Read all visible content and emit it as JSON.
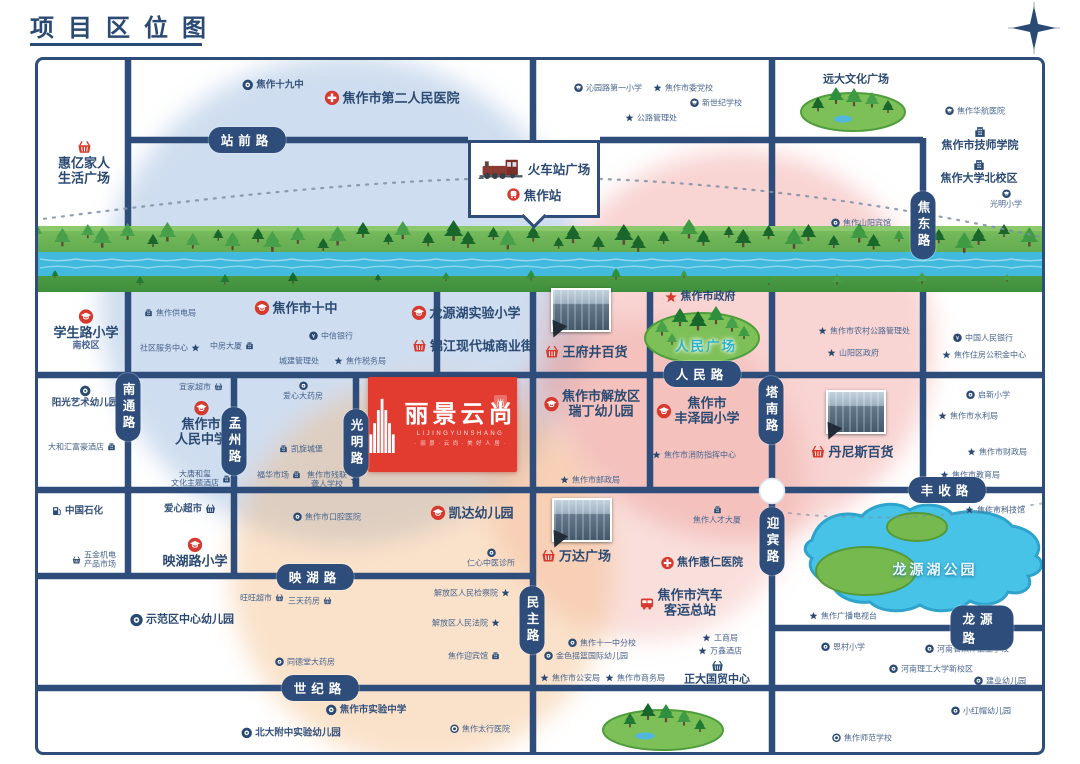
{
  "title": "项目区位图",
  "colors": {
    "navy": "#2b4a73",
    "road": "#2e4d7b",
    "red": "#d6392e",
    "river": "#41bade",
    "lake": "#47c3e8",
    "green": "#58a84e",
    "zone_blue": "rgba(132,170,214,0.40)",
    "zone_pink": "rgba(236,142,138,0.38)",
    "zone_pink2": "rgba(236,150,140,0.30)",
    "zone_orange": "rgba(244,186,128,0.42)"
  },
  "station": {
    "plaza_label": "火车站广场",
    "station_label": "焦作站"
  },
  "project": {
    "name": "丽景云尚",
    "pinyin": "LIJINGYUNSHANG",
    "tagline": "· 丽 景 · 云 尚 · 美 好 人 居 ·",
    "seal_text": "尚"
  },
  "lake_label": "龙源湖公园",
  "roads": [
    {
      "name": "站前路",
      "o": "h",
      "x": 247,
      "y": 140
    },
    {
      "name": "人民路",
      "o": "h",
      "x": 702,
      "y": 374
    },
    {
      "name": "丰收路",
      "o": "h",
      "x": 947,
      "y": 490
    },
    {
      "name": "映湖路",
      "o": "h",
      "x": 315,
      "y": 577
    },
    {
      "name": "龙源路",
      "o": "h",
      "x": 982,
      "y": 628
    },
    {
      "name": "世纪路",
      "o": "h",
      "x": 320,
      "y": 688
    },
    {
      "name": "南通路",
      "o": "v",
      "x": 128,
      "y": 407
    },
    {
      "name": "孟州路",
      "o": "v",
      "x": 234,
      "y": 441
    },
    {
      "name": "光明路",
      "o": "v",
      "x": 356,
      "y": 443
    },
    {
      "name": "民主路",
      "o": "v",
      "x": 532,
      "y": 620
    },
    {
      "name": "塔南路",
      "o": "v",
      "x": 771,
      "y": 410
    },
    {
      "name": "迎宾路",
      "o": "v",
      "x": 772,
      "y": 541
    },
    {
      "name": "焦东路",
      "o": "v",
      "x": 923,
      "y": 225
    }
  ],
  "photos": [
    {
      "name": "wangfujing-photo",
      "x": 581,
      "y": 310
    },
    {
      "name": "dennis-photo",
      "x": 856,
      "y": 412
    },
    {
      "name": "wanda-photo",
      "x": 582,
      "y": 520
    }
  ],
  "pois": [
    {
      "lines": [
        "惠亿家人",
        "生活广场"
      ],
      "icon": "basket",
      "color": "red",
      "size": "lg",
      "col": true,
      "x": 84,
      "y": 163
    },
    {
      "label": "焦作十九中",
      "icon": "circle",
      "color": "navy",
      "size": "sm",
      "x": 273,
      "y": 85
    },
    {
      "label": "焦作市第二人民医院",
      "icon": "hospital",
      "color": "red",
      "size": "lg",
      "x": 392,
      "y": 98
    },
    {
      "label": "沁园路第一小学",
      "icon": "school",
      "color": "navy",
      "size": "xs",
      "x": 608,
      "y": 88
    },
    {
      "label": "焦作市委党校",
      "icon": "star",
      "color": "navy",
      "size": "xs",
      "x": 683,
      "y": 88
    },
    {
      "label": "新世纪学校",
      "icon": "school",
      "color": "navy",
      "size": "xs",
      "x": 716,
      "y": 103
    },
    {
      "label": "公路管理处",
      "icon": "star",
      "color": "navy",
      "size": "xs",
      "x": 651,
      "y": 118
    },
    {
      "label": "远大文化广场",
      "size": "md",
      "x": 856,
      "y": 80
    },
    {
      "label": "焦作华航医院",
      "icon": "school",
      "color": "navy",
      "size": "xs",
      "x": 975,
      "y": 111
    },
    {
      "label": "焦作市技师学院",
      "icon": "building",
      "color": "navy",
      "size": "md",
      "col": true,
      "x": 980,
      "y": 139
    },
    {
      "label": "焦作大学北校区",
      "icon": "building",
      "color": "navy",
      "size": "md",
      "col": true,
      "x": 979,
      "y": 172
    },
    {
      "label": "光明小学",
      "icon": "school",
      "color": "navy",
      "size": "xs",
      "col": true,
      "x": 1006,
      "y": 199
    },
    {
      "label": "焦作山阳宾馆",
      "icon": "circle",
      "color": "navy",
      "size": "xs",
      "x": 861,
      "y": 223
    },
    {
      "lines": [
        "学生路小学"
      ],
      "sub": "南校区",
      "icon": "school",
      "color": "red",
      "size": "lg",
      "col": true,
      "x": 86,
      "y": 330
    },
    {
      "label": "焦作供电局",
      "icon": "building",
      "color": "navy",
      "size": "xs",
      "x": 170,
      "y": 313
    },
    {
      "label": "焦作市十中",
      "icon": "school",
      "color": "red",
      "size": "lg",
      "x": 296,
      "y": 308
    },
    {
      "label": "社区服务中心",
      "icon": "star",
      "color": "navy",
      "size": "xs",
      "iconRight": true,
      "x": 170,
      "y": 348
    },
    {
      "label": "中房大厦",
      "icon": "building",
      "color": "navy",
      "size": "xs",
      "iconRight": true,
      "x": 232,
      "y": 346
    },
    {
      "label": "中信银行",
      "icon": "bank",
      "color": "navy",
      "size": "xs",
      "x": 331,
      "y": 336
    },
    {
      "label": "城建管理处",
      "size": "xs",
      "x": 299,
      "y": 361
    },
    {
      "label": "焦作税务局",
      "icon": "star",
      "color": "navy",
      "size": "xs",
      "x": 360,
      "y": 361
    },
    {
      "label": "龙源湖实验小学",
      "icon": "school",
      "color": "red",
      "size": "lg",
      "x": 466,
      "y": 313
    },
    {
      "label": "锦江现代城商业街",
      "icon": "basket",
      "color": "red",
      "size": "lg",
      "x": 473,
      "y": 346
    },
    {
      "label": "王府井百货",
      "icon": "basket",
      "color": "red",
      "size": "lg",
      "x": 586,
      "y": 352
    },
    {
      "label": "焦作市政府",
      "icon": "star",
      "color": "red",
      "size": "md",
      "x": 700,
      "y": 297
    },
    {
      "label": "人民广场",
      "cls": "park-label",
      "x": 706,
      "y": 347
    },
    {
      "label": "焦作市农村公路管理处",
      "icon": "star",
      "color": "navy",
      "size": "xs",
      "x": 864,
      "y": 331
    },
    {
      "label": "山阳区政府",
      "icon": "star",
      "color": "navy",
      "size": "xs",
      "x": 853,
      "y": 353
    },
    {
      "label": "中国人民银行",
      "icon": "bank",
      "color": "navy",
      "size": "xs",
      "x": 983,
      "y": 338
    },
    {
      "label": "焦作住房公积金中心",
      "icon": "star",
      "color": "navy",
      "size": "xs",
      "x": 984,
      "y": 355
    },
    {
      "label": "阳光艺术幼儿园",
      "icon": "circle",
      "color": "navy",
      "size": "sm",
      "col": true,
      "x": 85,
      "y": 397
    },
    {
      "label": "大和汇富豪酒店",
      "icon": "building",
      "color": "navy",
      "size": "xs",
      "iconRight": true,
      "x": 82,
      "y": 447
    },
    {
      "label": "宜家超市",
      "icon": "basket",
      "color": "navy",
      "size": "xs",
      "iconRight": true,
      "x": 201,
      "y": 387
    },
    {
      "lines": [
        "焦作市",
        "人民中学"
      ],
      "icon": "school",
      "color": "red",
      "size": "lg",
      "col": true,
      "x": 201,
      "y": 424
    },
    {
      "lines": [
        "大唐和玺",
        "文化主题酒店"
      ],
      "icon": "building",
      "color": "navy",
      "size": "xs",
      "iconRight": true,
      "x": 201,
      "y": 479
    },
    {
      "label": "爱心大药房",
      "icon": "circle",
      "color": "navy",
      "size": "xs",
      "col": true,
      "x": 303,
      "y": 391
    },
    {
      "label": "凯旋城堡",
      "icon": "building",
      "color": "navy",
      "size": "xs",
      "x": 301,
      "y": 449
    },
    {
      "label": "福华市场",
      "icon": "building",
      "color": "navy",
      "size": "xs",
      "iconRight": true,
      "x": 279,
      "y": 475
    },
    {
      "lines": [
        "焦作市残联",
        "聋人学校"
      ],
      "icon": "star",
      "color": "navy",
      "size": "xs",
      "iconRight": true,
      "x": 333,
      "y": 480
    },
    {
      "lines": [
        "焦作市解放区",
        "瑞丁幼儿园"
      ],
      "icon": "school",
      "color": "red",
      "size": "lg",
      "x": 592,
      "y": 404
    },
    {
      "lines": [
        "焦作市",
        "丰泽园小学"
      ],
      "icon": "school",
      "color": "red",
      "size": "lg",
      "x": 698,
      "y": 411
    },
    {
      "label": "焦作市消防指挥中心",
      "icon": "star",
      "color": "navy",
      "size": "xs",
      "x": 694,
      "y": 455
    },
    {
      "label": "焦作市邮政局",
      "icon": "star",
      "color": "navy",
      "size": "xs",
      "x": 590,
      "y": 480
    },
    {
      "label": "丹尼斯百货",
      "icon": "basket",
      "color": "red",
      "size": "lg",
      "x": 852,
      "y": 452
    },
    {
      "label": "启新小学",
      "icon": "circle",
      "color": "navy",
      "size": "xs",
      "x": 988,
      "y": 395
    },
    {
      "label": "焦作市水利局",
      "icon": "star",
      "color": "navy",
      "size": "xs",
      "x": 968,
      "y": 416
    },
    {
      "label": "焦作市财政局",
      "icon": "star",
      "color": "navy",
      "size": "xs",
      "x": 997,
      "y": 452
    },
    {
      "label": "焦作市教育局",
      "icon": "star",
      "color": "navy",
      "size": "xs",
      "x": 970,
      "y": 475
    },
    {
      "label": "中国石化",
      "icon": "gas",
      "color": "navy",
      "size": "sm",
      "x": 77,
      "y": 511
    },
    {
      "lines": [
        "五金机电",
        "产品市场"
      ],
      "icon": "basket",
      "color": "navy",
      "size": "xs",
      "x": 94,
      "y": 560
    },
    {
      "label": "爱心超市",
      "icon": "basket",
      "color": "navy",
      "size": "sm",
      "iconRight": true,
      "x": 190,
      "y": 509
    },
    {
      "label": "映湖路小学",
      "icon": "school",
      "color": "red",
      "size": "lg",
      "col": true,
      "x": 195,
      "y": 553
    },
    {
      "label": "焦作市口腔医院",
      "icon": "circle",
      "color": "navy",
      "size": "xs",
      "x": 327,
      "y": 517
    },
    {
      "label": "示范区中心幼儿园",
      "icon": "circle",
      "color": "navy",
      "size": "md",
      "x": 182,
      "y": 620
    },
    {
      "label": "旺旺超市",
      "icon": "basket",
      "color": "navy",
      "size": "xs",
      "iconRight": true,
      "x": 262,
      "y": 598
    },
    {
      "label": "三天药房",
      "icon": "basket",
      "color": "navy",
      "size": "xs",
      "iconRight": true,
      "x": 310,
      "y": 601
    },
    {
      "label": "同德堂大药房",
      "icon": "circle",
      "color": "navy",
      "size": "xs",
      "x": 305,
      "y": 662
    },
    {
      "label": "焦作市实验中学",
      "icon": "circle",
      "color": "navy",
      "size": "sm",
      "x": 366,
      "y": 710
    },
    {
      "label": "北大附中实验幼儿园",
      "icon": "circle",
      "color": "navy",
      "size": "sm",
      "x": 291,
      "y": 733
    },
    {
      "label": "焦作太行医院",
      "icon": "circle2",
      "color": "navy",
      "size": "xs",
      "x": 480,
      "y": 729
    },
    {
      "label": "解放区人民检察院",
      "icon": "star",
      "color": "navy",
      "size": "xs",
      "iconRight": true,
      "x": 472,
      "y": 593
    },
    {
      "label": "解放区人民法院",
      "icon": "star",
      "color": "navy",
      "size": "xs",
      "iconRight": true,
      "x": 466,
      "y": 623
    },
    {
      "label": "焦作迎宾馆",
      "icon": "building",
      "color": "navy",
      "size": "xs",
      "iconRight": true,
      "x": 474,
      "y": 656
    },
    {
      "label": "凯达幼儿园",
      "icon": "school",
      "color": "red",
      "size": "lg",
      "x": 472,
      "y": 513
    },
    {
      "label": "仁心中医诊所",
      "icon": "circle",
      "color": "navy",
      "size": "xs",
      "col": true,
      "x": 491,
      "y": 558
    },
    {
      "label": "万达广场",
      "icon": "basket",
      "color": "red",
      "size": "lg",
      "x": 576,
      "y": 556
    },
    {
      "label": "焦作人才大厦",
      "icon": "building",
      "color": "navy",
      "size": "xs",
      "col": true,
      "x": 717,
      "y": 515
    },
    {
      "label": "焦作惠仁医院",
      "icon": "hospital",
      "color": "red",
      "size": "md",
      "x": 702,
      "y": 563
    },
    {
      "lines": [
        "焦作市汽车",
        "客运总站"
      ],
      "icon": "bus",
      "color": "red",
      "size": "lg",
      "x": 681,
      "y": 603
    },
    {
      "label": "焦作十一中分校",
      "icon": "circle",
      "color": "navy",
      "size": "xs",
      "x": 602,
      "y": 643
    },
    {
      "label": "金色摇篮国际幼儿园",
      "icon": "circle",
      "color": "navy",
      "size": "xs",
      "x": 586,
      "y": 656
    },
    {
      "label": "焦作市公安局",
      "icon": "star",
      "color": "navy",
      "size": "xs",
      "x": 570,
      "y": 678
    },
    {
      "label": "焦作市商务局",
      "icon": "star",
      "color": "navy",
      "size": "xs",
      "x": 635,
      "y": 678
    },
    {
      "label": "工商局",
      "icon": "star",
      "color": "navy",
      "size": "xs",
      "x": 720,
      "y": 638
    },
    {
      "label": "万鑫酒店",
      "icon": "star",
      "color": "navy",
      "size": "xs",
      "x": 720,
      "y": 651
    },
    {
      "label": "正大国贸中心",
      "icon": "basket",
      "color": "navy",
      "size": "md",
      "col": true,
      "x": 717,
      "y": 673
    },
    {
      "label": "龙源湖公园",
      "cls": "lake-label",
      "x": 935,
      "y": 570
    },
    {
      "label": "焦作市科技馆",
      "icon": "star",
      "color": "navy",
      "size": "xs",
      "x": 995,
      "y": 510
    },
    {
      "label": "焦作广播电视台",
      "icon": "star",
      "color": "navy",
      "size": "xs",
      "x": 843,
      "y": 616
    },
    {
      "label": "恩村小学",
      "icon": "circle",
      "color": "navy",
      "size": "xs",
      "x": 843,
      "y": 647
    },
    {
      "label": "河南省焦作卫生学校",
      "icon": "circle",
      "color": "navy",
      "size": "xs",
      "x": 967,
      "y": 649
    },
    {
      "label": "河南理工大学新校区",
      "icon": "circle",
      "color": "navy",
      "size": "xs",
      "x": 931,
      "y": 669
    },
    {
      "label": "建业幼儿园",
      "icon": "circle",
      "color": "navy",
      "size": "xs",
      "x": 1000,
      "y": 681
    },
    {
      "label": "小红帽幼儿园",
      "icon": "circle",
      "color": "navy",
      "size": "xs",
      "x": 981,
      "y": 711
    },
    {
      "label": "焦作师范学校",
      "icon": "circle2",
      "color": "navy",
      "size": "xs",
      "x": 862,
      "y": 738
    }
  ]
}
